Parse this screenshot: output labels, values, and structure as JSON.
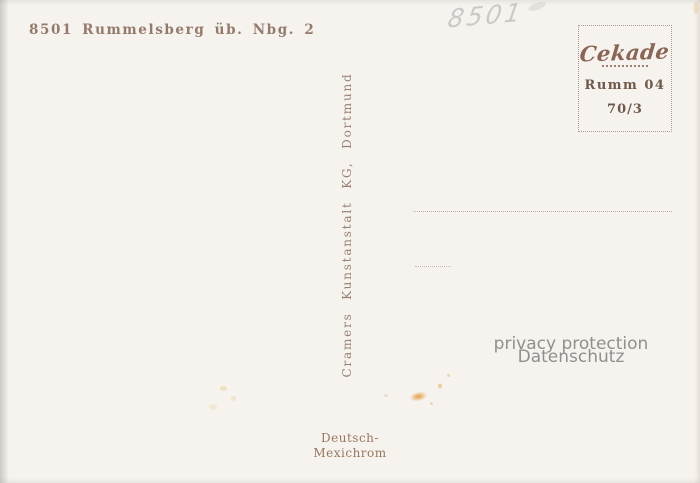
{
  "postcard": {
    "address_code": "8501 Rummelsberg üb. Nbg. 2",
    "handwriting": "8501",
    "stamp_box": {
      "logo": "Cekade",
      "line1": "Rumm 04",
      "line2": "70/3"
    },
    "publisher": "Cramers Kunstanstalt KG, Dortmund",
    "watermark": {
      "line1": "privacy protection",
      "line2": "Datenschutz"
    },
    "print_note": {
      "line1": "Deutsch-",
      "line2": "Mexichrom"
    },
    "colors": {
      "background": "#f6f3ee",
      "printed_text": "#8c7061",
      "stamp_logo": "#8a6455",
      "watermark": "#8f8f8f",
      "stain_orange": "#e08e26"
    }
  }
}
